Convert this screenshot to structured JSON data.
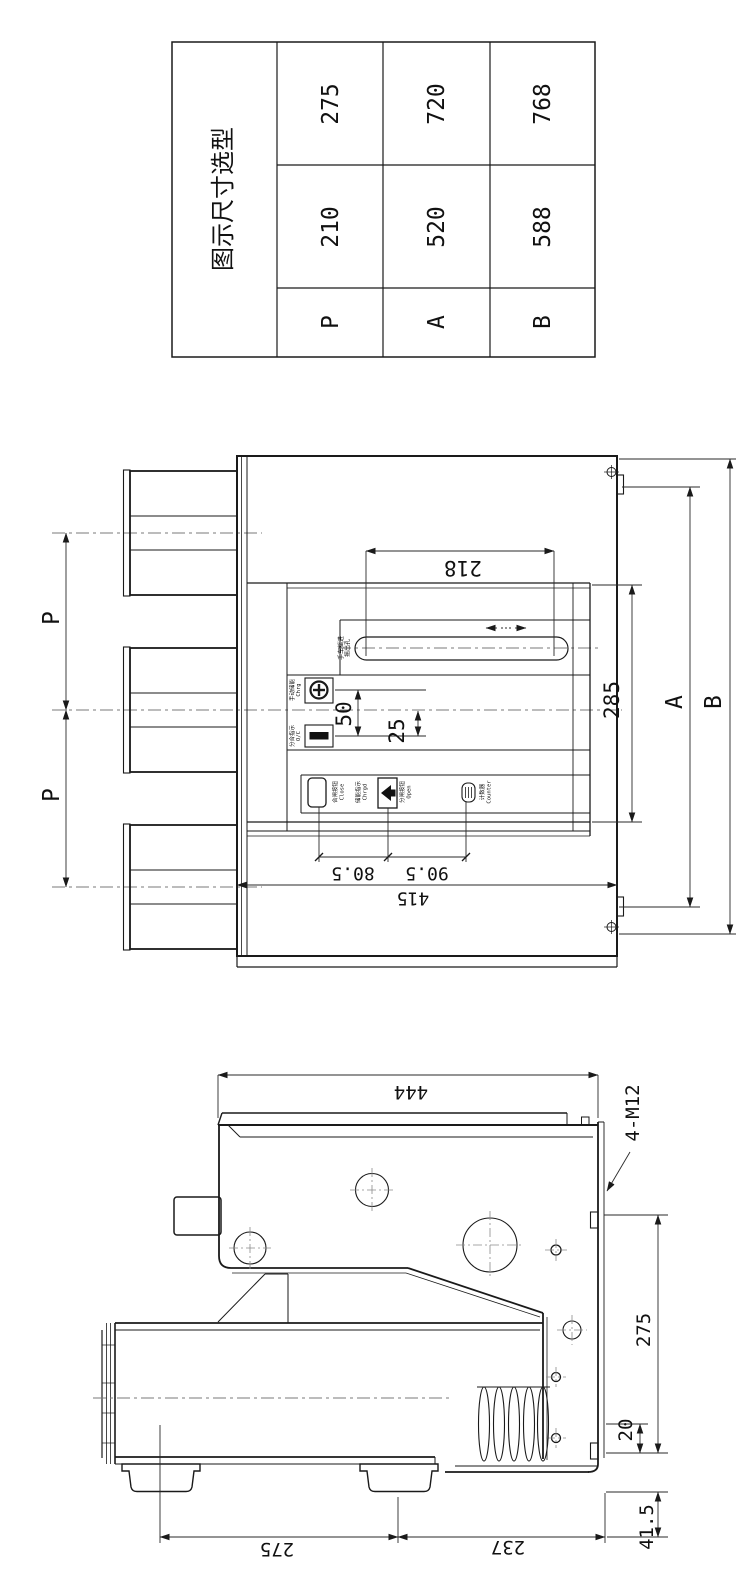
{
  "page": {
    "background": "#ffffff",
    "line_color": "#1a1a1a",
    "centerline_color": "#7a7a7a"
  },
  "selection_table": {
    "title": "图示尺寸选型",
    "rows": [
      [
        "275",
        "720",
        "768"
      ],
      [
        "210",
        "520",
        "588"
      ],
      [
        "P",
        "A",
        "B"
      ]
    ]
  },
  "front_view": {
    "dim_p_upper": "P",
    "dim_p_lower": "P",
    "dim_218": "218",
    "dim_285": "285",
    "dim_a": "A",
    "dim_b": "B",
    "dim_50": "50",
    "dim_25": "25",
    "dim_80_5": "80.5",
    "dim_90_5": "90.5",
    "dim_415": "415",
    "panel_labels": {
      "slot_l1": "手车摇进",
      "slot_l2": "摇出孔",
      "charge_l1": "手动储能",
      "charge_l2": "Chrg",
      "indicator_l1": "分合指示",
      "indicator_l2": "O/C",
      "close_btn_l1": "合闸按钮",
      "close_btn_l2": "Close",
      "charged_l1": "储能指示",
      "charged_l2": "Chrgd",
      "open_btn_l1": "分闸按钮",
      "open_btn_l2": "Open",
      "counter_l1": "计数器",
      "counter_l2": "Counter"
    }
  },
  "side_view": {
    "dim_444": "444",
    "dim_4_m12": "4-M12",
    "dim_275_right": "275",
    "dim_20": "20",
    "dim_41_5": "41.5",
    "dim_275_bottom": "275",
    "dim_237": "237"
  }
}
